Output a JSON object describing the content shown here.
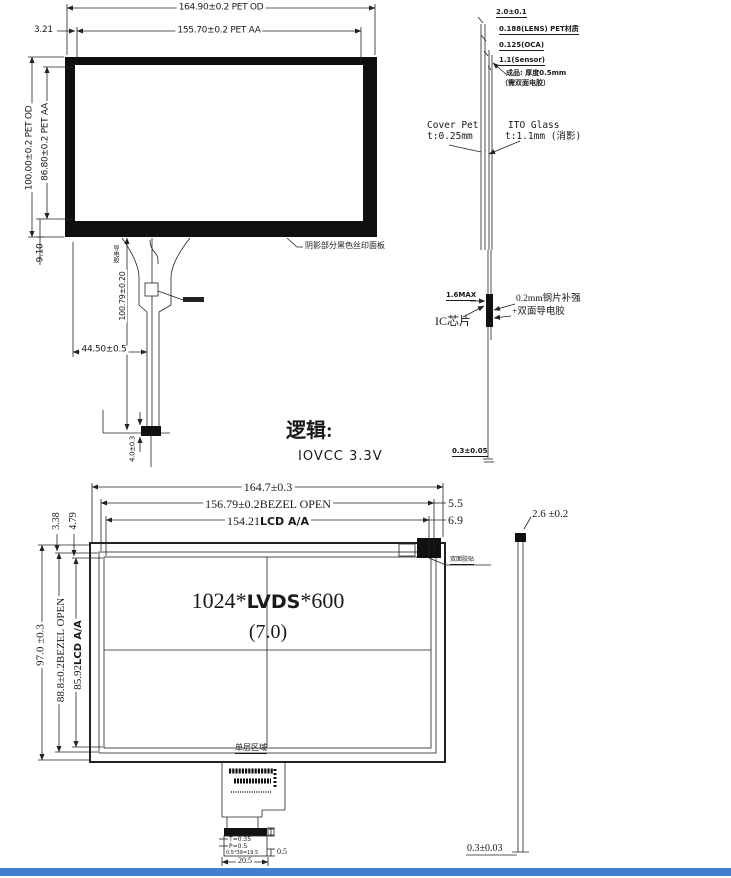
{
  "footer": {
    "color": "#3f7fd6"
  },
  "drawing1": {
    "pet_od_width": "164.90±0.2 PET OD",
    "pet_aa_width": "155.70±0.2 PET AA",
    "left_offset": "3.21",
    "pet_od_height": "100.00±0.2 PET OD",
    "pet_aa_height": "86.80±0.2 PET AA",
    "bottom_offset": "9.10",
    "silkscreen_note": "阴影部分黑色丝印面板",
    "conductive_adhesive_label": "导电胶",
    "tail_length": "100.79±0.20",
    "tail_offset": "44.50±0.5",
    "connector_dim": "4.0±0.3"
  },
  "stackup": {
    "total_thickness": "2.0±0.1",
    "layer_lens": "0.188(LENS) PET材质",
    "layer_oca": "0.125(OCA)",
    "layer_sensor": "1.1(Sensor)",
    "adhesive_note_line1": "成品: 厚度0.5mm",
    "adhesive_note_line2": "（需双面电胶）",
    "cover_pet_name": "Cover Pet",
    "cover_pet_thickness": "t:0.25mm",
    "ito_glass_name": "ITO Glass",
    "ito_glass_thickness": "t:1.1mm (消影)",
    "ic_height_max": "1.6MAX",
    "stiffener_note_line1": "0.2mm钢片补强",
    "stiffener_note_line2": "+双面导电胶",
    "ic_label": "IC芯片",
    "fpc_thickness": "0.3±0.05"
  },
  "logic": {
    "heading": "逻辑:",
    "io_vcc": "IOVCC 3.3V"
  },
  "drawing2": {
    "outline_width": "164.7±0.3",
    "bezel_width_value": "156.79±0.2",
    "bezel_open_label": "BEZEL OPEN",
    "aa_width_value": "154.21",
    "lcd_aa_label": "LCD A/A",
    "right_offset_bezel": "5.5",
    "right_offset_aa": "6.9",
    "top_offset_bezel": "3.38",
    "top_offset_aa": "4.79",
    "outline_height": "97.0 ±0.3",
    "bezel_height_value": "88.8±0.2",
    "aa_height_value": "85.92",
    "resolution_prefix": "1024*",
    "resolution_interface": "LVDS",
    "resolution_suffix": "*600",
    "panel_size": "(7.0)",
    "tape_label": "双面胶贴",
    "single_layer_label": "单层区域",
    "pin_width": "T=0.35",
    "pin_pitch": "P=0.5",
    "pitch_equation": "0.5*39=19.5",
    "connector_width": "20.5",
    "connector_edge": "0.5"
  },
  "sideview": {
    "module_thickness": "2.6 ±0.2",
    "fpc_thickness": "0.3±0.03"
  }
}
